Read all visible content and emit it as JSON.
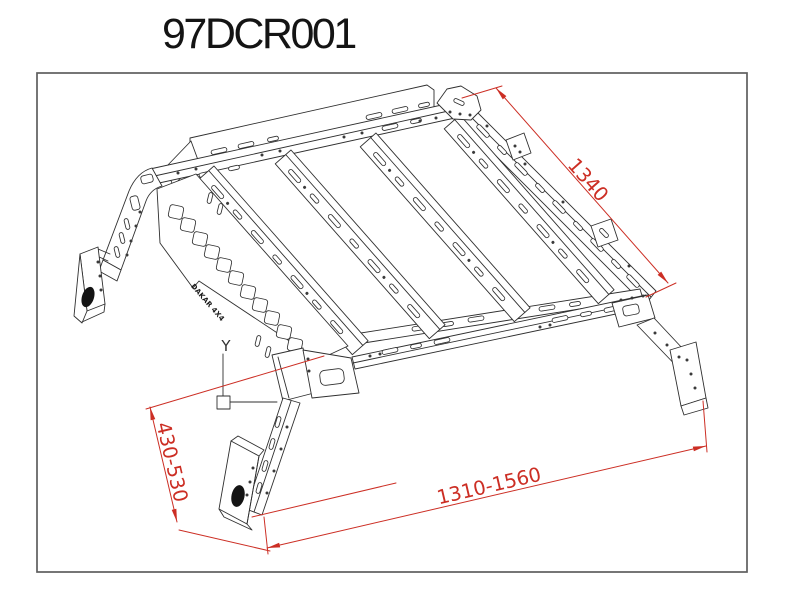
{
  "title": "97DCR001",
  "drawing": {
    "axis_marker": "Y",
    "part_label": "DAKAR 4X4",
    "dimensions": [
      {
        "id": "rail-length",
        "label": "1340"
      },
      {
        "id": "leg-height-range",
        "label": "430-530"
      },
      {
        "id": "base-width-range",
        "label": "1310-1560"
      }
    ],
    "colors": {
      "dimension_red": "#cc2e24",
      "line_black": "#2f2f2f",
      "frame_gray": "#5f5f5f",
      "background": "#ffffff"
    }
  }
}
